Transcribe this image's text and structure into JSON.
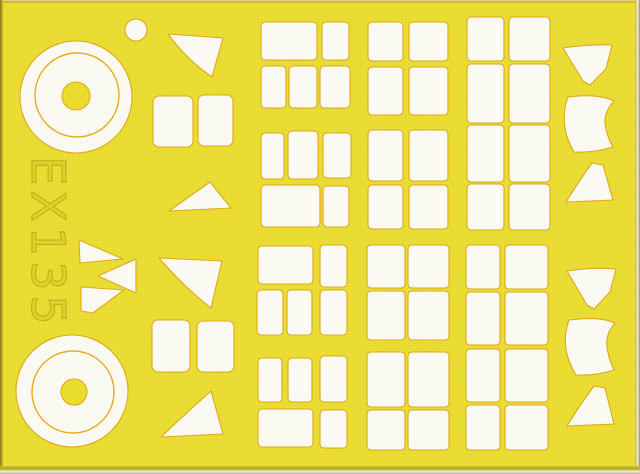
{
  "sheet": {
    "product_code": "EX135"
  },
  "colors": {
    "sheet_yellow": "#eadd30",
    "mask_white": "#fbfaf2",
    "cut_line": "#dfa81c",
    "ring_line": "#e3ad1d",
    "engraving": "#c6b41d"
  },
  "shapes": [
    {
      "type": "circle",
      "name": "small-circle-mask",
      "cx": 136,
      "cy": 30,
      "r": 11
    },
    {
      "type": "circle",
      "name": "wheel-mask-top-outer",
      "cx": 76,
      "cy": 97,
      "r": 56
    },
    {
      "type": "circle",
      "name": "wheel-mask-top-ring",
      "cx": 77,
      "cy": 95,
      "r": 42,
      "fill": "none",
      "stroke": "#e3ad1d",
      "sw": 1.4
    },
    {
      "type": "circle",
      "name": "wheel-mask-top-hub",
      "cx": 76,
      "cy": 96,
      "r": 14,
      "fill": "yellow"
    },
    {
      "type": "circle",
      "name": "wheel-mask-bottom-outer",
      "cx": 72,
      "cy": 391,
      "r": 56
    },
    {
      "type": "circle",
      "name": "wheel-mask-bottom-ring",
      "cx": 73,
      "cy": 392,
      "r": 41,
      "fill": "none",
      "stroke": "#e3ad1d",
      "sw": 1.4
    },
    {
      "type": "circle",
      "name": "wheel-mask-bottom-hub",
      "cx": 74,
      "cy": 392,
      "r": 13,
      "fill": "yellow"
    },
    {
      "type": "path",
      "name": "fan-blade-mask",
      "d": "M79,240 L123,259 L80,263 Z"
    },
    {
      "type": "path",
      "name": "fan-blade-mask",
      "d": "M136,259 L136,293 L98,276 Z"
    },
    {
      "type": "path",
      "name": "fan-blade-mask",
      "d": "M81,287 L124,290 L93,313 L81,311 Z"
    },
    {
      "type": "path",
      "name": "wedge-mask",
      "d": "M168,34 L223,38 L212,77 Q187,60 168,34 Z"
    },
    {
      "type": "rect",
      "name": "square-mask",
      "x": 153,
      "y": 96,
      "w": 40,
      "h": 51,
      "rx": 6
    },
    {
      "type": "rect",
      "name": "square-mask",
      "x": 198,
      "y": 95,
      "w": 35,
      "h": 51,
      "rx": 6
    },
    {
      "type": "path",
      "name": "triangle-mask",
      "d": "M210,182 Q193,194 169,211 L231,208 Z"
    },
    {
      "type": "path",
      "name": "wedge-mask",
      "d": "M159,258 L222,261 L211,308 Q184,287 159,258 Z"
    },
    {
      "type": "rect",
      "name": "square-mask",
      "x": 152,
      "y": 320,
      "w": 38,
      "h": 52,
      "rx": 6
    },
    {
      "type": "rect",
      "name": "square-mask",
      "x": 197,
      "y": 321,
      "w": 37,
      "h": 51,
      "rx": 6
    },
    {
      "type": "path",
      "name": "triangle-mask",
      "d": "M211,391 Q195,405 161,437 L223,434 Z"
    },
    {
      "type": "rect",
      "name": "rect-mask",
      "x": 261,
      "y": 22,
      "w": 56,
      "h": 38
    },
    {
      "type": "rect",
      "name": "rect-mask",
      "x": 322,
      "y": 22,
      "w": 27,
      "h": 38
    },
    {
      "type": "rect",
      "name": "rect-mask",
      "x": 261,
      "y": 66,
      "w": 25,
      "h": 42
    },
    {
      "type": "rect",
      "name": "rect-mask",
      "x": 289,
      "y": 66,
      "w": 28,
      "h": 42
    },
    {
      "type": "rect",
      "name": "rect-mask",
      "x": 320,
      "y": 66,
      "w": 30,
      "h": 42
    },
    {
      "type": "rect",
      "name": "rect-mask",
      "x": 261,
      "y": 133,
      "w": 23,
      "h": 46
    },
    {
      "type": "rect",
      "name": "rect-mask",
      "x": 288,
      "y": 131,
      "w": 30,
      "h": 48
    },
    {
      "type": "rect",
      "name": "rect-mask",
      "x": 323,
      "y": 133,
      "w": 28,
      "h": 45
    },
    {
      "type": "rect",
      "name": "rect-mask",
      "x": 261,
      "y": 185,
      "w": 59,
      "h": 42
    },
    {
      "type": "rect",
      "name": "rect-mask",
      "x": 323,
      "y": 186,
      "w": 26,
      "h": 41
    },
    {
      "type": "rect",
      "name": "rect-mask",
      "x": 258,
      "y": 246,
      "w": 55,
      "h": 38
    },
    {
      "type": "rect",
      "name": "rect-mask",
      "x": 320,
      "y": 245,
      "w": 27,
      "h": 42
    },
    {
      "type": "rect",
      "name": "rect-mask",
      "x": 257,
      "y": 290,
      "w": 26,
      "h": 45
    },
    {
      "type": "rect",
      "name": "rect-mask",
      "x": 287,
      "y": 290,
      "w": 25,
      "h": 45
    },
    {
      "type": "rect",
      "name": "rect-mask",
      "x": 320,
      "y": 290,
      "w": 27,
      "h": 45
    },
    {
      "type": "rect",
      "name": "rect-mask",
      "x": 258,
      "y": 358,
      "w": 24,
      "h": 44
    },
    {
      "type": "rect",
      "name": "rect-mask",
      "x": 288,
      "y": 358,
      "w": 24,
      "h": 44
    },
    {
      "type": "rect",
      "name": "rect-mask",
      "x": 320,
      "y": 356,
      "w": 27,
      "h": 46
    },
    {
      "type": "rect",
      "name": "rect-mask",
      "x": 258,
      "y": 409,
      "w": 55,
      "h": 38
    },
    {
      "type": "rect",
      "name": "rect-mask",
      "x": 320,
      "y": 410,
      "w": 27,
      "h": 38
    },
    {
      "type": "rect",
      "name": "rect-mask",
      "x": 368,
      "y": 22,
      "w": 35,
      "h": 39
    },
    {
      "type": "rect",
      "name": "rect-mask",
      "x": 409,
      "y": 22,
      "w": 39,
      "h": 39
    },
    {
      "type": "rect",
      "name": "rect-mask",
      "x": 368,
      "y": 67,
      "w": 35,
      "h": 48
    },
    {
      "type": "rect",
      "name": "rect-mask",
      "x": 409,
      "y": 67,
      "w": 39,
      "h": 48
    },
    {
      "type": "rect",
      "name": "rect-mask",
      "x": 368,
      "y": 130,
      "w": 35,
      "h": 51
    },
    {
      "type": "rect",
      "name": "rect-mask",
      "x": 409,
      "y": 130,
      "w": 39,
      "h": 51
    },
    {
      "type": "rect",
      "name": "rect-mask",
      "x": 368,
      "y": 185,
      "w": 35,
      "h": 44
    },
    {
      "type": "rect",
      "name": "rect-mask",
      "x": 409,
      "y": 185,
      "w": 39,
      "h": 44
    },
    {
      "type": "rect",
      "name": "rect-mask",
      "x": 367,
      "y": 245,
      "w": 38,
      "h": 43
    },
    {
      "type": "rect",
      "name": "rect-mask",
      "x": 408,
      "y": 245,
      "w": 41,
      "h": 43
    },
    {
      "type": "rect",
      "name": "rect-mask",
      "x": 367,
      "y": 291,
      "w": 38,
      "h": 49
    },
    {
      "type": "rect",
      "name": "rect-mask",
      "x": 408,
      "y": 291,
      "w": 41,
      "h": 49
    },
    {
      "type": "rect",
      "name": "rect-mask",
      "x": 367,
      "y": 352,
      "w": 38,
      "h": 55
    },
    {
      "type": "rect",
      "name": "rect-mask",
      "x": 408,
      "y": 352,
      "w": 41,
      "h": 55
    },
    {
      "type": "rect",
      "name": "rect-mask",
      "x": 367,
      "y": 410,
      "w": 38,
      "h": 40
    },
    {
      "type": "rect",
      "name": "rect-mask",
      "x": 408,
      "y": 410,
      "w": 41,
      "h": 40
    },
    {
      "type": "rect",
      "name": "rect-mask",
      "x": 467,
      "y": 17,
      "w": 37,
      "h": 44
    },
    {
      "type": "rect",
      "name": "rect-mask",
      "x": 509,
      "y": 17,
      "w": 41,
      "h": 44
    },
    {
      "type": "rect",
      "name": "rect-mask",
      "x": 467,
      "y": 64,
      "w": 37,
      "h": 59
    },
    {
      "type": "rect",
      "name": "rect-mask",
      "x": 509,
      "y": 64,
      "w": 41,
      "h": 59
    },
    {
      "type": "rect",
      "name": "rect-mask",
      "x": 467,
      "y": 125,
      "w": 37,
      "h": 57
    },
    {
      "type": "rect",
      "name": "rect-mask",
      "x": 509,
      "y": 125,
      "w": 41,
      "h": 57
    },
    {
      "type": "rect",
      "name": "rect-mask",
      "x": 467,
      "y": 184,
      "w": 37,
      "h": 46
    },
    {
      "type": "rect",
      "name": "rect-mask",
      "x": 509,
      "y": 184,
      "w": 41,
      "h": 46
    },
    {
      "type": "rect",
      "name": "rect-mask",
      "x": 466,
      "y": 245,
      "w": 34,
      "h": 44
    },
    {
      "type": "rect",
      "name": "rect-mask",
      "x": 505,
      "y": 245,
      "w": 43,
      "h": 44
    },
    {
      "type": "rect",
      "name": "rect-mask",
      "x": 466,
      "y": 292,
      "w": 34,
      "h": 53
    },
    {
      "type": "rect",
      "name": "rect-mask",
      "x": 505,
      "y": 292,
      "w": 43,
      "h": 53
    },
    {
      "type": "rect",
      "name": "rect-mask",
      "x": 466,
      "y": 349,
      "w": 34,
      "h": 53
    },
    {
      "type": "rect",
      "name": "rect-mask",
      "x": 505,
      "y": 349,
      "w": 43,
      "h": 53
    },
    {
      "type": "rect",
      "name": "rect-mask",
      "x": 466,
      "y": 405,
      "w": 34,
      "h": 45
    },
    {
      "type": "rect",
      "name": "rect-mask",
      "x": 505,
      "y": 405,
      "w": 43,
      "h": 45
    },
    {
      "type": "path",
      "name": "canopy-windscreen-mask",
      "d": "M563,48 Q589,44 612,45 L606,69 L590,85 L583,81 Z"
    },
    {
      "type": "path",
      "name": "canopy-main-mask",
      "d": "M568,97 Q598,93 614,101 Q604,112 605,124 Q607,137 613,147 Q594,153 574,152 Q558,125 568,97 Z"
    },
    {
      "type": "path",
      "name": "canopy-rear-mask",
      "d": "M592,163 L603,165 L613,200 L566,202 Q579,181 592,163 Z"
    },
    {
      "type": "path",
      "name": "canopy-windscreen-mask",
      "d": "M567,271 Q593,267 616,269 L610,292 L594,309 L587,305 Z"
    },
    {
      "type": "path",
      "name": "canopy-main-mask",
      "d": "M569,320 Q600,316 615,323 Q605,335 607,347 Q609,360 614,370 Q596,376 576,375 Q559,348 569,320 Z"
    },
    {
      "type": "path",
      "name": "canopy-rear-mask",
      "d": "M594,386 L605,388 L614,424 L567,426 Q581,403 594,386 Z"
    }
  ]
}
